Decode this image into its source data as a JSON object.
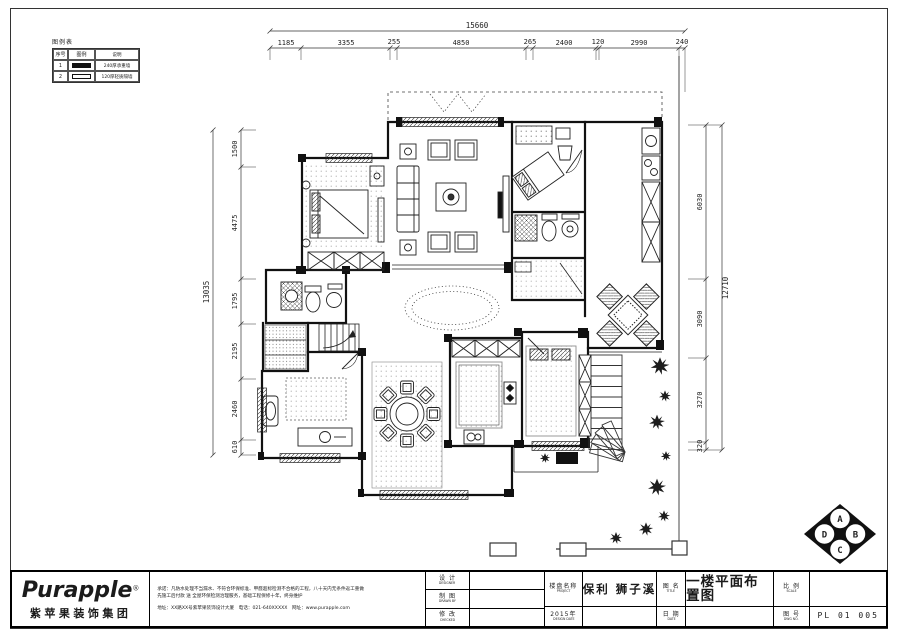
{
  "legend": {
    "title": "图例表",
    "col_no": "序号",
    "col_symbol": "图例",
    "col_desc": "说明",
    "rows": [
      {
        "no": "1",
        "desc": "240厚承重墙"
      },
      {
        "no": "2",
        "desc": "120厚轻质隔墙"
      }
    ]
  },
  "dims": {
    "top": {
      "total": "15660",
      "segments": [
        "1185",
        "3355",
        "255",
        "4850",
        "265",
        "2400",
        "120",
        "2990",
        "240"
      ]
    },
    "left": {
      "total": "13035",
      "segments": [
        "1500",
        "4475",
        "1795",
        "2195",
        "2460",
        "610"
      ]
    },
    "right": {
      "total": "12710",
      "segments": [
        "6030",
        "3090",
        "3270",
        "320"
      ]
    }
  },
  "compass": {
    "a": "A",
    "b": "B",
    "c": "C",
    "d": "D"
  },
  "titleblock": {
    "brand": "Purapple",
    "brand_reg": "®",
    "brand_cn": "紫苹果装饰集团",
    "promise_line1": "承诺：凡防水处理不当漏水、不符合环保标准、甲醛超标检测不合格的工程，八十天内无条件返工重做",
    "promise_line2": "先施工后付款 送 全屋环保检测治理服务，基础工程保修十年，终身维护",
    "address_line": "地址：XX路XX号紫苹果装饰设计大厦　电话：021-640XXXXX　网址：www.purapple.com",
    "design_label": "设 计",
    "design_en": "DESIGNER",
    "draw_label": "制 图",
    "draw_en": "DRAWN BY",
    "check_label": "修 改",
    "check_en": "CHECKED",
    "project_label": "楼盘名称",
    "project_en": "PROJECT",
    "date_label": "2015年",
    "date_en": "DESIGN DATE",
    "project_name": "保利 狮子溪",
    "dwgname_label": "图 名",
    "dwgname_en": "TITLE",
    "date2_label": "日 期",
    "date2_en": "DATE",
    "drawing_title": "一楼平面布置图",
    "scale_label": "比 例",
    "scale_en": "SCALE",
    "no_label": "图 号",
    "no_en": "DWG NO.",
    "drawing_no": "PL 01 005"
  }
}
